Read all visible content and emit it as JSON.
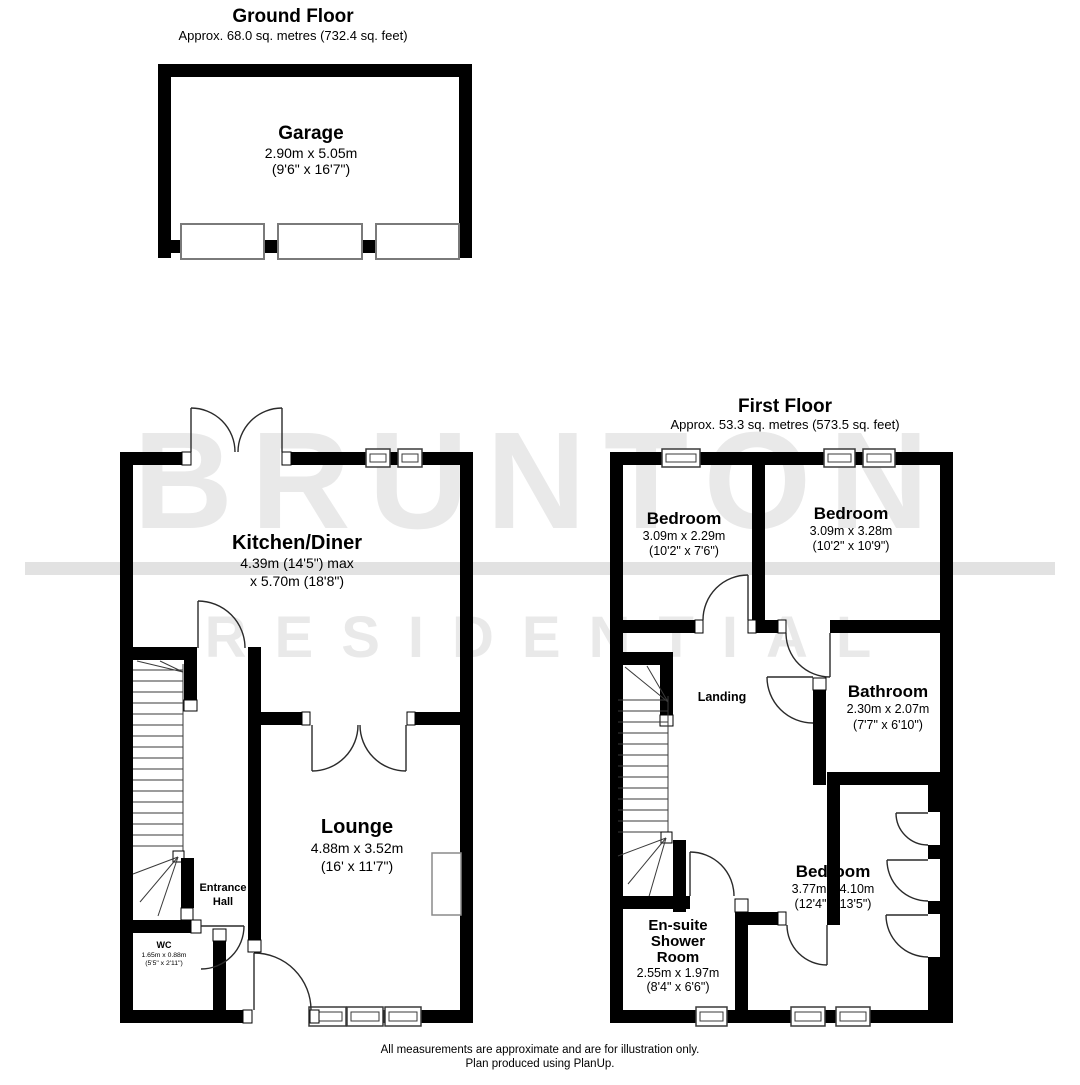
{
  "watermark": {
    "line1": "BRUNTON",
    "line2": "RESIDENTIAL"
  },
  "ground_floor": {
    "title": "Ground Floor",
    "area": "Approx. 68.0 sq. metres (732.4 sq. feet)",
    "rooms": {
      "garage": {
        "name": "Garage",
        "metric": "2.90m x 5.05m",
        "imperial": "(9'6\" x 16'7\")"
      },
      "kitchen": {
        "name": "Kitchen/Diner",
        "metric": "4.39m (14'5\") max",
        "metric2": "x 5.70m (18'8\")"
      },
      "lounge": {
        "name": "Lounge",
        "metric": "4.88m x 3.52m",
        "imperial": "(16' x 11'7\")"
      },
      "entrance_hall": {
        "name_line1": "Entrance",
        "name_line2": "Hall"
      },
      "wc": {
        "name": "WC",
        "metric": "1.65m x 0.88m",
        "imperial": "(5'5\" x 2'11\")"
      }
    }
  },
  "first_floor": {
    "title": "First Floor",
    "area": "Approx. 53.3 sq. metres (573.5 sq. feet)",
    "rooms": {
      "bedroom1": {
        "name": "Bedroom",
        "metric": "3.09m x 2.29m",
        "imperial": "(10'2\" x 7'6\")"
      },
      "bedroom2": {
        "name": "Bedroom",
        "metric": "3.09m x 3.28m",
        "imperial": "(10'2\" x 10'9\")"
      },
      "bedroom3": {
        "name": "Bedroom",
        "metric": "3.77m x 4.10m",
        "imperial": "(12'4\" x 13'5\")"
      },
      "bathroom": {
        "name": "Bathroom",
        "metric": "2.30m x 2.07m",
        "imperial": "(7'7\" x 6'10\")"
      },
      "landing": {
        "name": "Landing"
      },
      "ensuite": {
        "name_line1": "En-suite",
        "name_line2": "Shower",
        "name_line3": "Room",
        "metric": "2.55m x 1.97m",
        "imperial": "(8'4\" x 6'6\")"
      }
    }
  },
  "footer": {
    "line1": "All measurements are approximate and are for illustration only.",
    "line2": "Plan produced using PlanUp."
  },
  "colors": {
    "wall": "#000000",
    "watermark": "#e9e9e9",
    "band": "#e2e2e2"
  }
}
